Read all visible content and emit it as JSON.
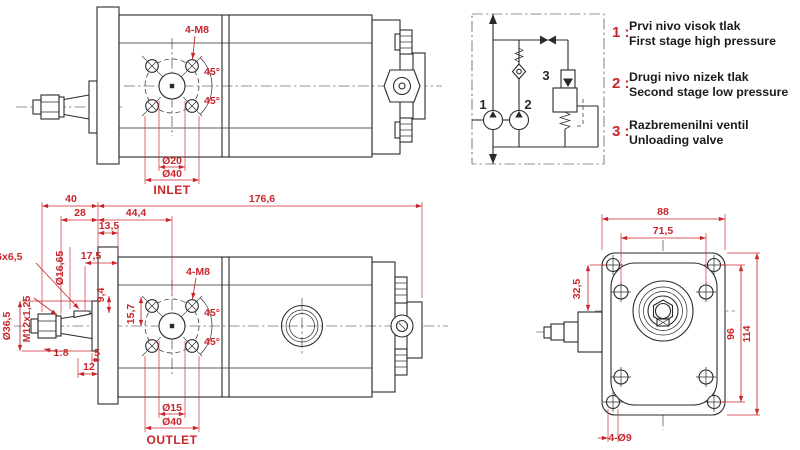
{
  "colors": {
    "dimension_red": "#c9262b",
    "line_dark": "#2a2a2a",
    "background": "#ffffff"
  },
  "top_view": {
    "bolt_pattern": "4-M8",
    "angle_upper": "45°",
    "angle_lower": "45°",
    "dia_inner": "Ø20",
    "dia_outer": "Ø40",
    "port": "INLET"
  },
  "side_view": {
    "dim_40": "40",
    "dim_28": "28",
    "dim_44_4": "44,4",
    "dim_176_6": "176,6",
    "dim_13_5": "13,5",
    "key": "3,16x6,5",
    "dia_16_65": "Ø16,65",
    "dim_17_5": "17,5",
    "dim_9_4": "9,4",
    "dia_36_5": "Ø36,5",
    "thread": "M12x1,25",
    "dim_15_7": "15,7",
    "bolt_pattern": "4-M8",
    "angle_upper": "45°",
    "angle_lower": "45°",
    "taper": "1:8",
    "dim_5": "5",
    "dim_12": "12",
    "dia_inner": "Ø15",
    "dia_outer": "Ø40",
    "port": "OUTLET"
  },
  "front_view": {
    "dim_88": "88",
    "dim_71_5": "71,5",
    "dim_32_5": "32,5",
    "dim_96": "96",
    "dim_114": "114",
    "holes": "4-Ø9"
  },
  "schematic": {
    "pump1": "1",
    "pump2": "2",
    "valve": "3",
    "legend": [
      {
        "num": "1 :",
        "line1": "Prvi nivo visok tlak",
        "line2": "First stage high pressure"
      },
      {
        "num": "2 :",
        "line1": "Drugi nivo nizek tlak",
        "line2": "Second stage low pressure"
      },
      {
        "num": "3 :",
        "line1": "Razbremenilni ventil",
        "line2": "Unloading valve"
      }
    ]
  }
}
